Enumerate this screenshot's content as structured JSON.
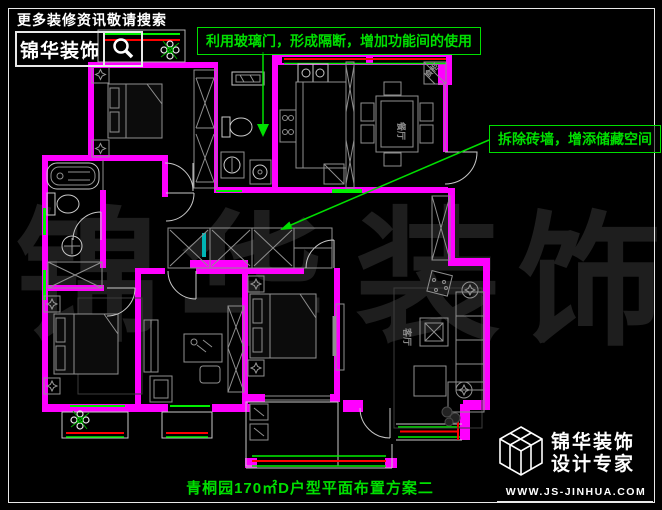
{
  "header": {
    "search_hint": "更多装修资讯敬请搜索",
    "brand": "锦华装饰",
    "search_icon": "magnifier-icon"
  },
  "annotations": {
    "glass_door": "利用玻璃门，形成隔断，增加功能间的使用",
    "storage": "拆除砖墙，增添储藏空间"
  },
  "rooms": {
    "dining": "餐厅",
    "living": "客厅",
    "cabinet": "食柜"
  },
  "watermark": {
    "chars": [
      "锦",
      "华",
      "装",
      "饰"
    ]
  },
  "title": "青桐园170㎡D户型平面布置方案二",
  "footer_logo": {
    "brand_line1": "锦华装饰",
    "brand_line2": "设计专家",
    "url": "WWW.JS-JINHUA.COM",
    "cube_icon": "wireframe-cube-logo-icon"
  },
  "colors": {
    "bg": "#000000",
    "frame": "#E8E8E8",
    "text_white": "#FFFFFF",
    "wall": "#FF00FF",
    "ann_green": "#00DF00",
    "win_green": "#00F000",
    "win_red": "#FF0000",
    "teal": "#00B4B4",
    "fur": "#8F8F8F",
    "fur_light": "#C8C8C8",
    "fur_dark": "#3C3C3C",
    "watermark": "#1E1E1E"
  }
}
